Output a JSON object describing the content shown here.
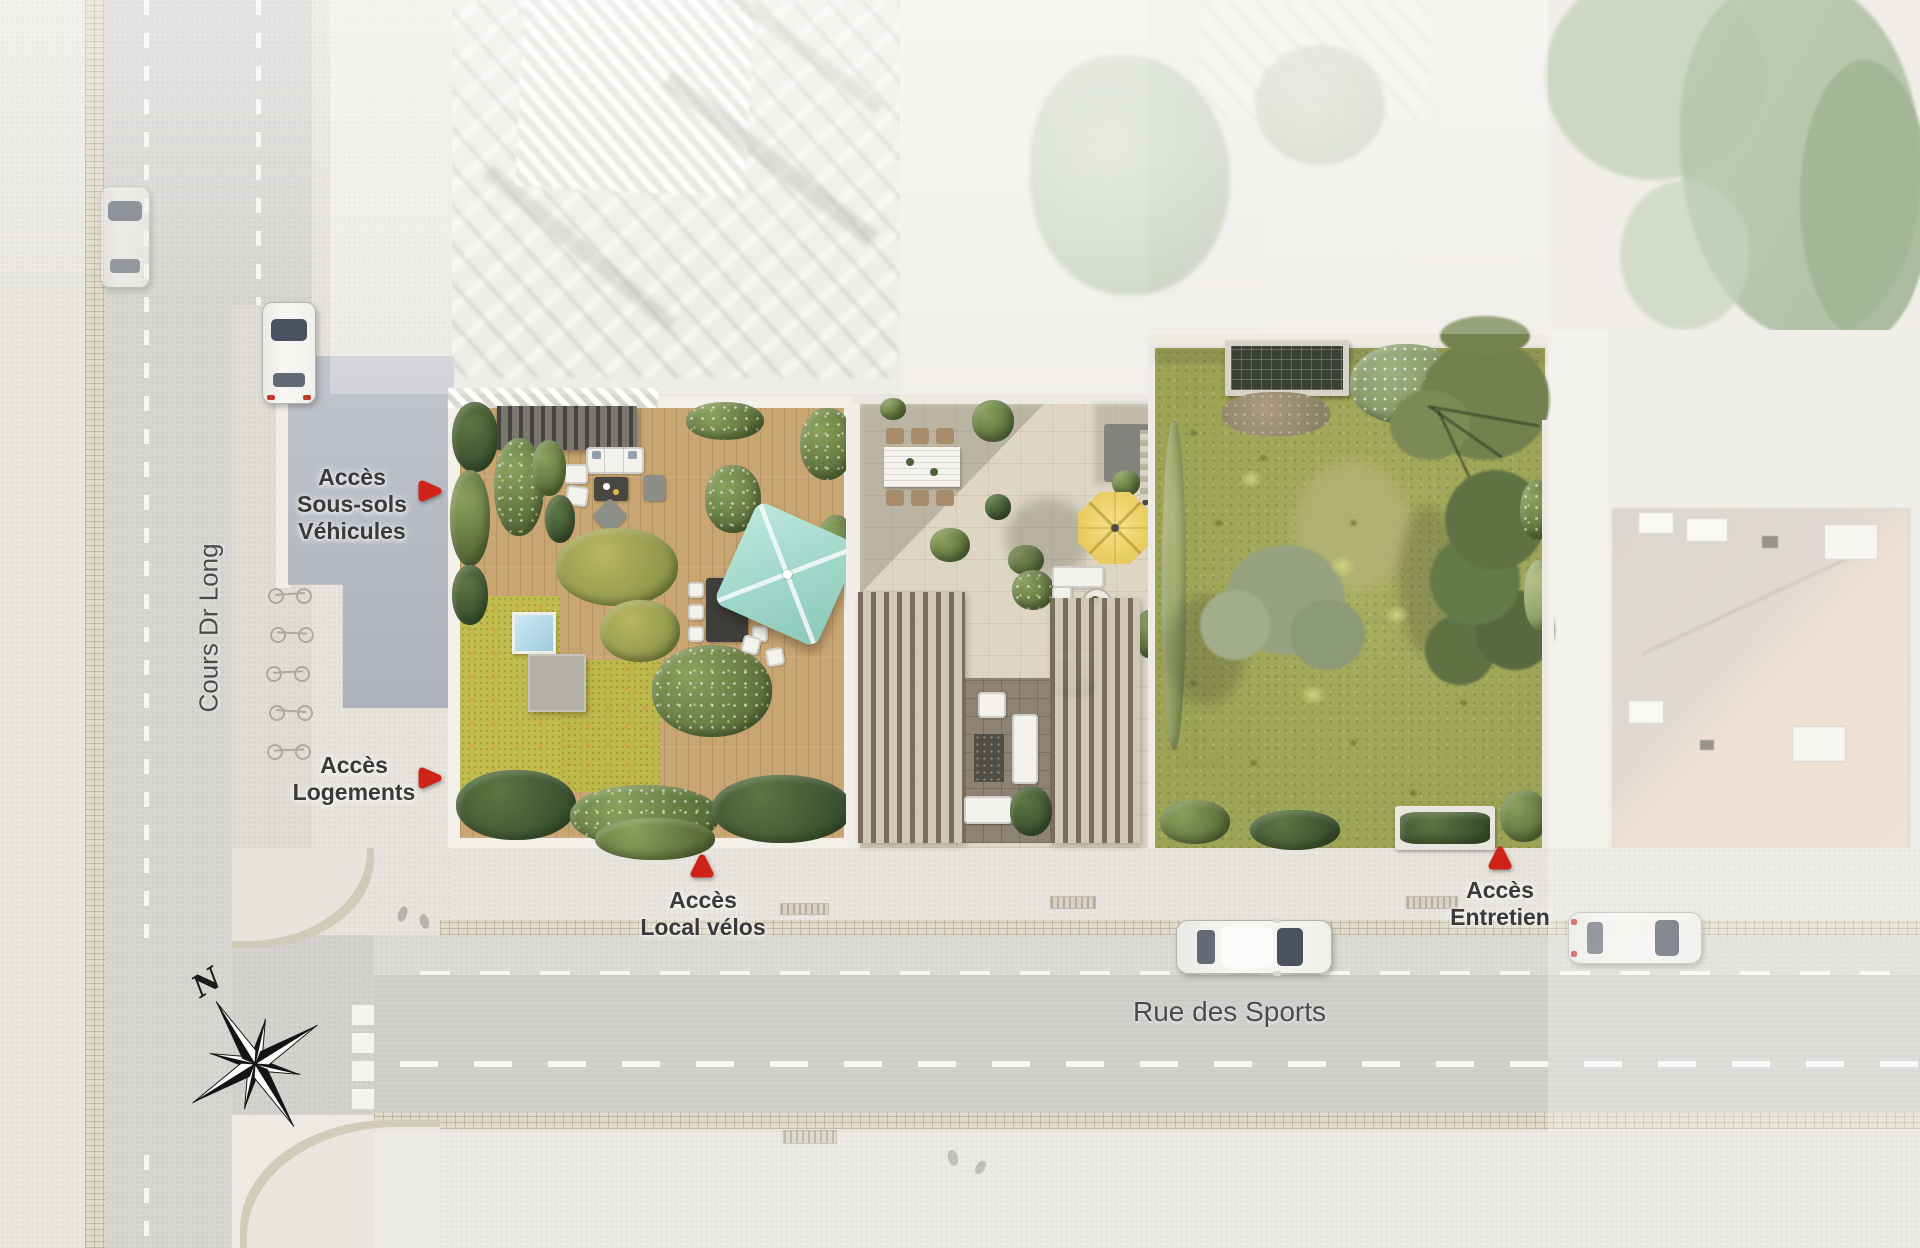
{
  "plan": {
    "access_labels": [
      {
        "id": "vehicles",
        "lines": [
          "Accès",
          "Sous-sols",
          "Véhicules"
        ],
        "marker": "right-arrow-marker"
      },
      {
        "id": "housing",
        "lines": [
          "Accès",
          "Logements"
        ],
        "marker": "right-arrow-marker"
      },
      {
        "id": "bikes",
        "lines": [
          "Accès",
          "Local vélos"
        ],
        "marker": "up-arrow-marker"
      },
      {
        "id": "maintenance",
        "lines": [
          "Accès",
          "Entretien"
        ],
        "marker": "up-arrow-marker"
      }
    ],
    "streets": {
      "west": "Cours Dr Long",
      "south": "Rue des Sports"
    },
    "compass": {
      "north_label": "N",
      "icon": "compass-rose-icon"
    },
    "colors": {
      "marker_red": "#cf2318",
      "label_text": "#3a3a3a",
      "street_text": "#4b4b4b",
      "deck_wood": "#c9a572",
      "sedum_green": "#c1bc4e",
      "meadow_green": "#9da355",
      "parasol_teal": "#a3d8ca",
      "umbrella_yellow": "#e9cf62",
      "paving_beige": "#ded6c3",
      "forecourt_grey": "#b8bbc5",
      "asphalt": "#d6d5d2",
      "roof_salmon": "#ead8c6"
    }
  }
}
